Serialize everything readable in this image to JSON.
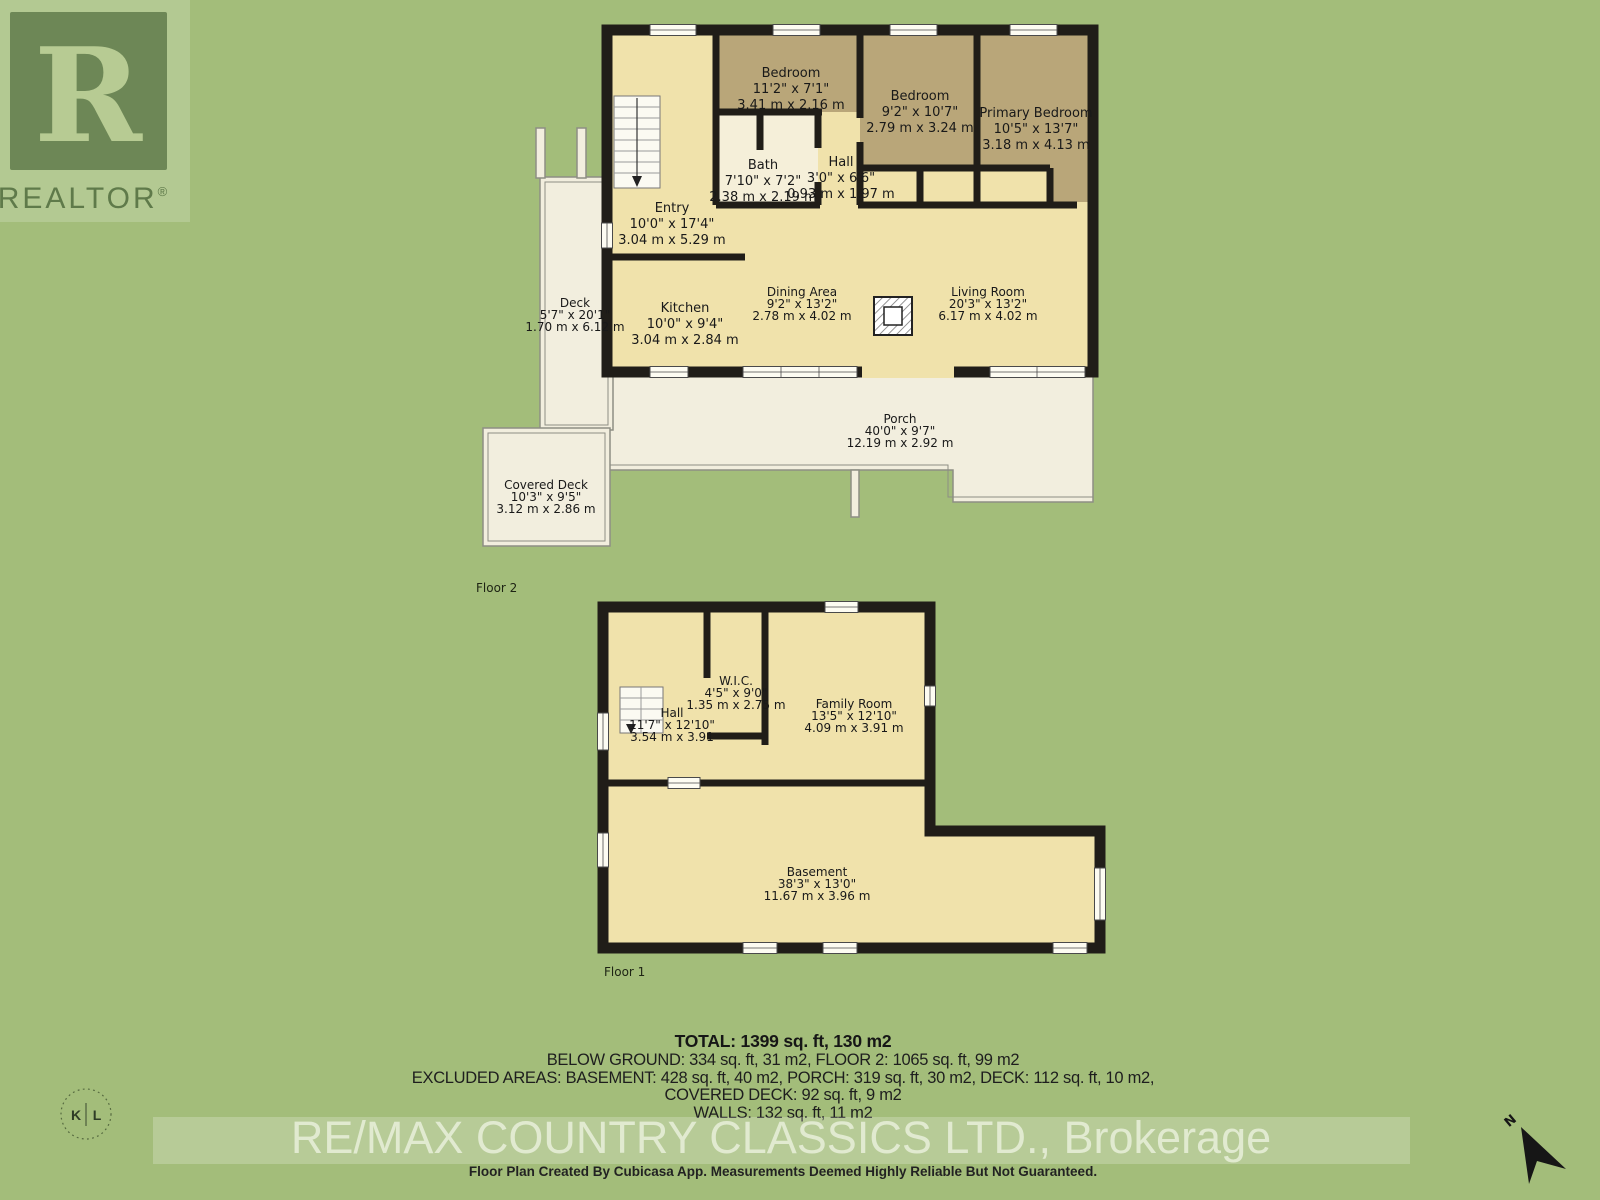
{
  "colors": {
    "background_green": "#a3bd7a",
    "floor_cream": "#f0e2ab",
    "bedroom_tan": "#b9a679",
    "bath_light": "#f5efd9",
    "deck_offwhite": "#f2eede",
    "wall_black": "#201d18"
  },
  "branding": {
    "realtor_logo_letter": "R",
    "realtor_logo_text": "REALTOR",
    "realtor_reg_mark": "®",
    "photo_logo_left": "K",
    "photo_logo_right": "L",
    "watermark": "RE/MAX COUNTRY CLASSICS LTD., Brokerage",
    "disclaimer": "Floor Plan Created By Cubicasa App. Measurements Deemed Highly Reliable But Not Guaranteed.",
    "north_label": "N"
  },
  "summary": {
    "total": "TOTAL: 1399 sq. ft, 130 m2",
    "below_ground": "BELOW GROUND: 334 sq. ft, 31 m2, FLOOR 2: 1065 sq. ft, 99 m2",
    "excluded": "EXCLUDED AREAS: BASEMENT: 428 sq. ft, 40 m2, PORCH: 319 sq. ft, 30 m2, DECK: 112 sq. ft, 10 m2,",
    "covered_deck": "COVERED DECK: 92 sq. ft, 9 m2",
    "walls": "WALLS: 132 sq. ft, 11 m2"
  },
  "floor2": {
    "label": "Floor 2",
    "rooms": [
      {
        "name": "Bedroom",
        "imperial": "11'2\" x 7'1\"",
        "metric": "3.41 m x 2.16 m"
      },
      {
        "name": "Bedroom",
        "imperial": "9'2\" x 10'7\"",
        "metric": "2.79 m x 3.24 m"
      },
      {
        "name": "Primary Bedroom",
        "imperial": "10'5\" x 13'7\"",
        "metric": "3.18 m x 4.13 m"
      },
      {
        "name": "Bath",
        "imperial": "7'10\" x 7'2\"",
        "metric": "2.38 m x 2.19 m"
      },
      {
        "name": "Hall",
        "imperial": "3'0\" x 6'6\"",
        "metric": "0.93 m x 1.97 m"
      },
      {
        "name": "Entry",
        "imperial": "10'0\" x 17'4\"",
        "metric": "3.04 m x 5.29 m"
      },
      {
        "name": "Kitchen",
        "imperial": "10'0\" x 9'4\"",
        "metric": "3.04 m x 2.84 m"
      },
      {
        "name": "Dining Area",
        "imperial": "9'2\" x 13'2\"",
        "metric": "2.78 m x 4.02 m"
      },
      {
        "name": "Living Room",
        "imperial": "20'3\" x 13'2\"",
        "metric": "6.17 m x 4.02 m"
      },
      {
        "name": "Deck",
        "imperial": "5'7\" x 20'1\"",
        "metric": "1.70 m x 6.12 m"
      },
      {
        "name": "Porch",
        "imperial": "40'0\" x 9'7\"",
        "metric": "12.19 m x 2.92 m"
      },
      {
        "name": "Covered Deck",
        "imperial": "10'3\" x 9'5\"",
        "metric": "3.12 m x 2.86 m"
      }
    ]
  },
  "floor1": {
    "label": "Floor 1",
    "rooms": [
      {
        "name": "W.I.C.",
        "imperial": "4'5\" x 9'0\"",
        "metric": "1.35 m x 2.75 m"
      },
      {
        "name": "Hall",
        "imperial": "11'7\" x 12'10\"",
        "metric": "3.54 m x 3.91"
      },
      {
        "name": "Family Room",
        "imperial": "13'5\" x 12'10\"",
        "metric": "4.09 m x 3.91 m"
      },
      {
        "name": "Basement",
        "imperial": "38'3\" x 13'0\"",
        "metric": "11.67 m x 3.96 m"
      }
    ]
  }
}
